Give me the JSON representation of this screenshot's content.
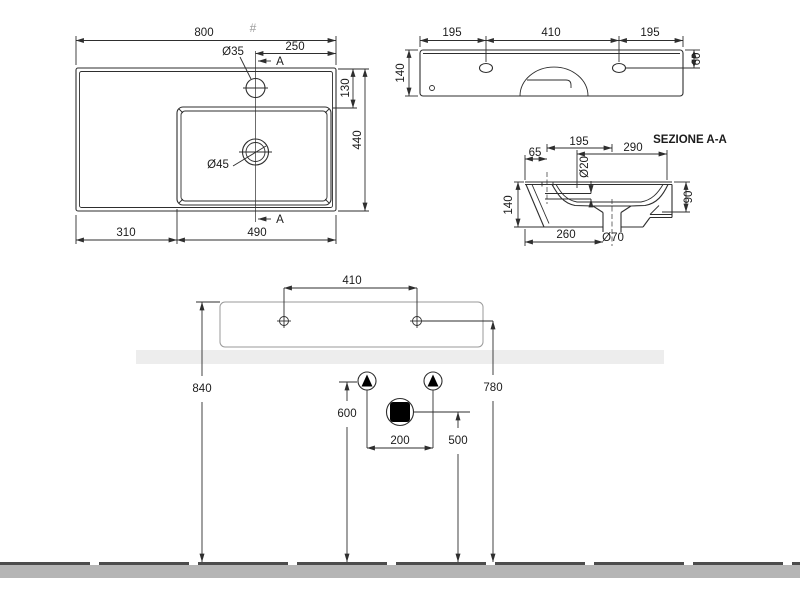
{
  "colors": {
    "line": "#2e2e2e",
    "light_line": "#9a9a9a",
    "wall_band": "#ededed",
    "floor_band": "#b5b5b5",
    "floor_line": "#4c4c4c",
    "symbol_fill": "#000000"
  },
  "plan": {
    "width": "800",
    "hash": "#",
    "faucet_dia": "Ø35",
    "offset_250": "250",
    "marker_a": "A",
    "depth_130": "130",
    "depth_440": "440",
    "drain_dia": "Ø45",
    "left_310": "310",
    "right_490": "490"
  },
  "front": {
    "left_195": "195",
    "center_410": "410",
    "right_195": "195",
    "height_140": "140",
    "hole_offset_60": "60"
  },
  "section": {
    "title": "SEZIONE A-A",
    "rear_65": "65",
    "span_195": "195",
    "span_290": "290",
    "hole_dia_20": "Ø20",
    "height_140": "140",
    "bowl_depth_90": "90",
    "drain_offset_260": "260",
    "drain_dia_70": "Ø70"
  },
  "installation": {
    "holes_410": "410",
    "height_840": "840",
    "holes_height_780": "780",
    "supply_height_600": "600",
    "drain_height_500": "500",
    "supply_spacing_200": "200"
  }
}
